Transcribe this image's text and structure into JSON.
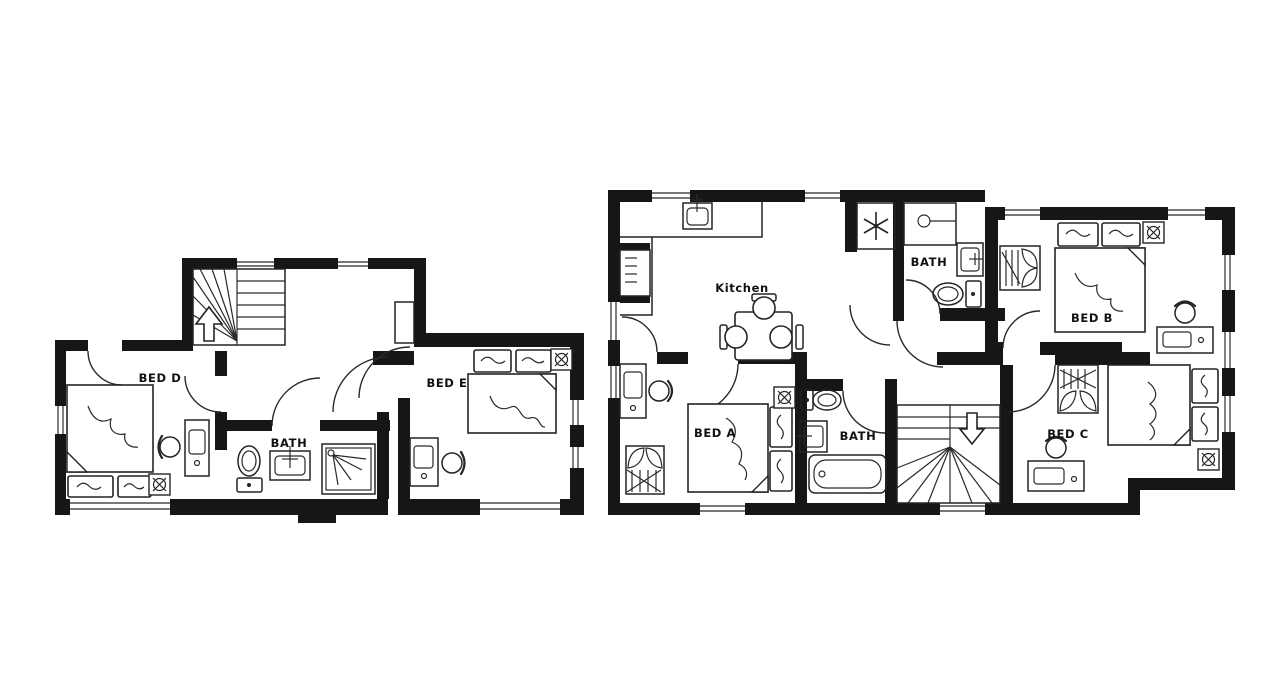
{
  "image": {
    "type": "floor-plan-drawing",
    "background_color": "#ffffff",
    "ink_color": "#161616"
  },
  "plans": [
    {
      "name": "left-floor-plan",
      "rooms": [
        {
          "id": "bed-d",
          "label": "BED D"
        },
        {
          "id": "bath",
          "label": "BATH"
        },
        {
          "id": "bed-e",
          "label": "BED E"
        }
      ],
      "features": [
        "staircase-up-arrow",
        "double-bed",
        "desk-chair",
        "toilet",
        "sink",
        "shower"
      ]
    },
    {
      "name": "right-floor-plan",
      "rooms": [
        {
          "id": "kitchen",
          "label": "Kitchen"
        },
        {
          "id": "bath-top",
          "label": "BATH"
        },
        {
          "id": "bed-b",
          "label": "BED B"
        },
        {
          "id": "bed-a",
          "label": "BED A"
        },
        {
          "id": "bath-bottom",
          "label": "BATH"
        },
        {
          "id": "bed-c",
          "label": "BED C"
        }
      ],
      "features": [
        "staircase-down-arrow",
        "kitchen-counter",
        "dining-table",
        "fridge-freezer",
        "bathtub",
        "wardrobes"
      ]
    }
  ]
}
